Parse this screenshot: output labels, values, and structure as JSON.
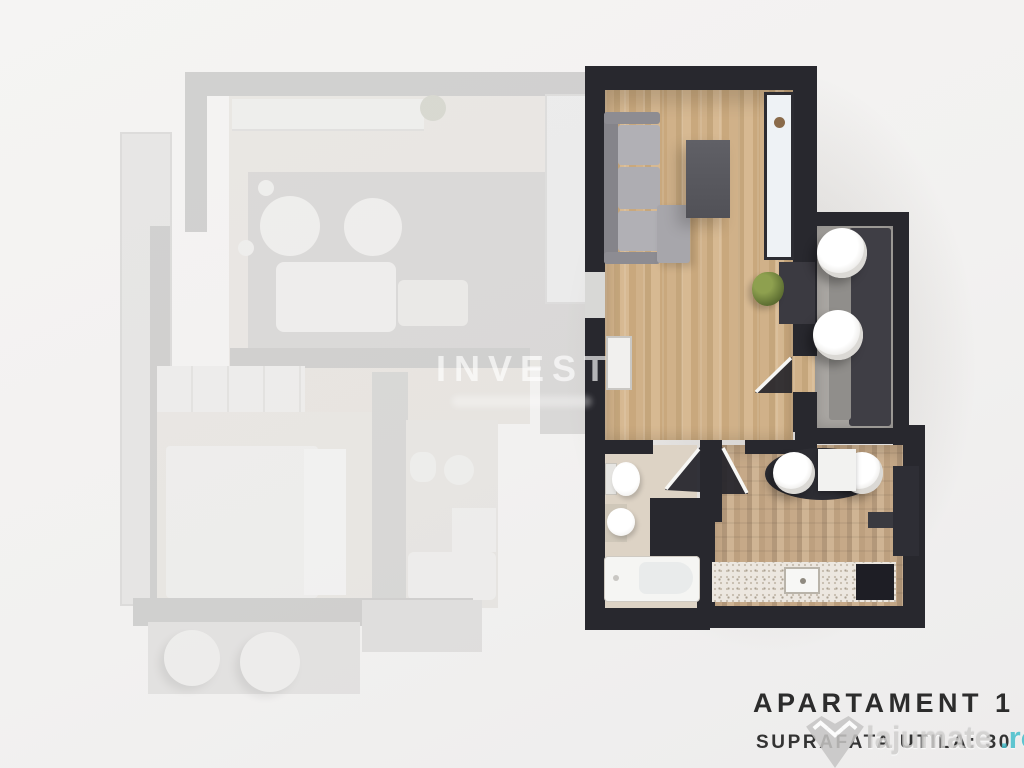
{
  "caption": {
    "title": "APARTAMENT 1",
    "subtitle": "SUPRAFATA UTILA: 30"
  },
  "watermarks": {
    "invest": "INVEST",
    "lajumate_name": "lajumate",
    "lajumate_tld": ".ro"
  },
  "colors": {
    "wall_dark": "#28282e",
    "wood_light": "#d0b189",
    "wood_mid": "#c5a67c",
    "kitchen_wood": "#c6a988",
    "balcony_floor": "#a9a6a2",
    "bath_floor": "#ddd3c5",
    "counter_speckle": "#ece7e0",
    "accent_teal": "#46bfcc",
    "caption_text": "#2c2c2c",
    "faded_wall": "#b5b4b3",
    "faded_floor": "#eae4d9",
    "background": "#f2f1f0"
  },
  "floorplan": {
    "highlighted_unit": {
      "label": "apartment-1",
      "rooms": [
        "living-room",
        "balcony",
        "hallway",
        "bathroom",
        "kitchen"
      ],
      "furniture": [
        "sofa",
        "tv-unit",
        "window",
        "wardrobe",
        "credenza",
        "plant",
        "balcony-bench",
        "balcony-chair",
        "balcony-chair",
        "toilet",
        "sink",
        "bathtub",
        "dining-table",
        "dining-chair",
        "dining-chair",
        "kitchen-counter",
        "kitchen-sink",
        "stove",
        "fridge"
      ]
    },
    "faded_unit": {
      "label": "adjacent-apartment",
      "rooms": [
        "living-room",
        "bedroom",
        "bathroom",
        "balcony"
      ],
      "furniture": [
        "shelf",
        "rug",
        "round-table",
        "round-table",
        "sofa",
        "wardrobe",
        "bed",
        "pillows",
        "toilet",
        "sink",
        "shower",
        "bathtub",
        "balcony-chair",
        "balcony-chair"
      ]
    }
  }
}
